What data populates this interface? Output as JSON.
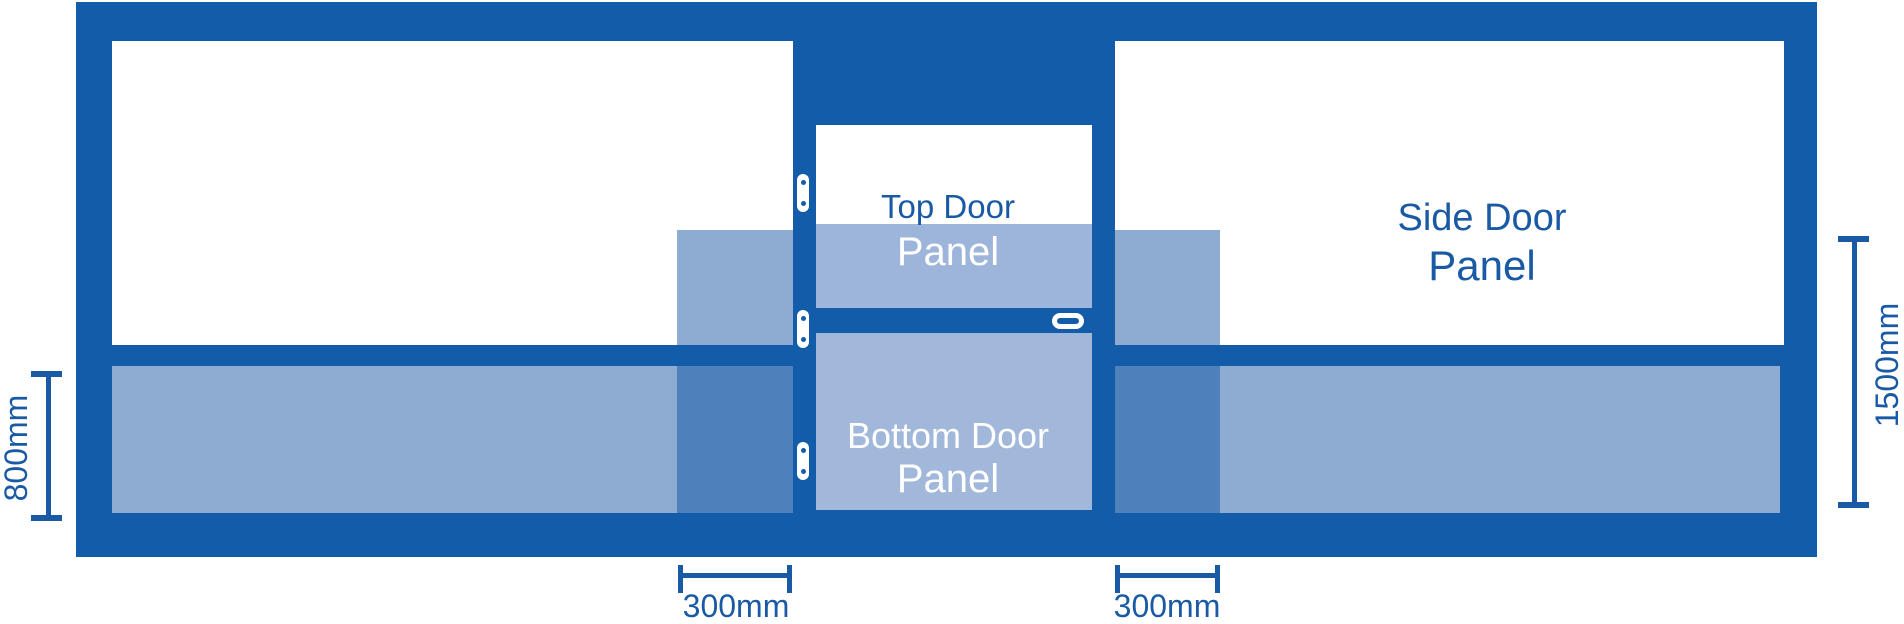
{
  "diagram": {
    "labels": {
      "top_door": {
        "line1": "Top Door",
        "line2": "Panel"
      },
      "bottom_door": {
        "line1": "Bottom Door",
        "line2": "Panel"
      },
      "side_door": {
        "line1": "Side Door",
        "line2": "Panel"
      }
    },
    "dimensions": {
      "left_height": "800mm",
      "right_height": "1500mm",
      "left_width": "300mm",
      "right_width": "300mm"
    },
    "colors": {
      "background": "#FFFFFF",
      "frame": "#125CA9",
      "panel_overlay": "#8EACD2",
      "overlay_overlap": "#4E80BB",
      "door_panel": "#A2B8DB",
      "door_panel_tint": "#9DB5DA",
      "label_dark": "#1A5AA5",
      "label_light": "#FFFFFF"
    }
  }
}
